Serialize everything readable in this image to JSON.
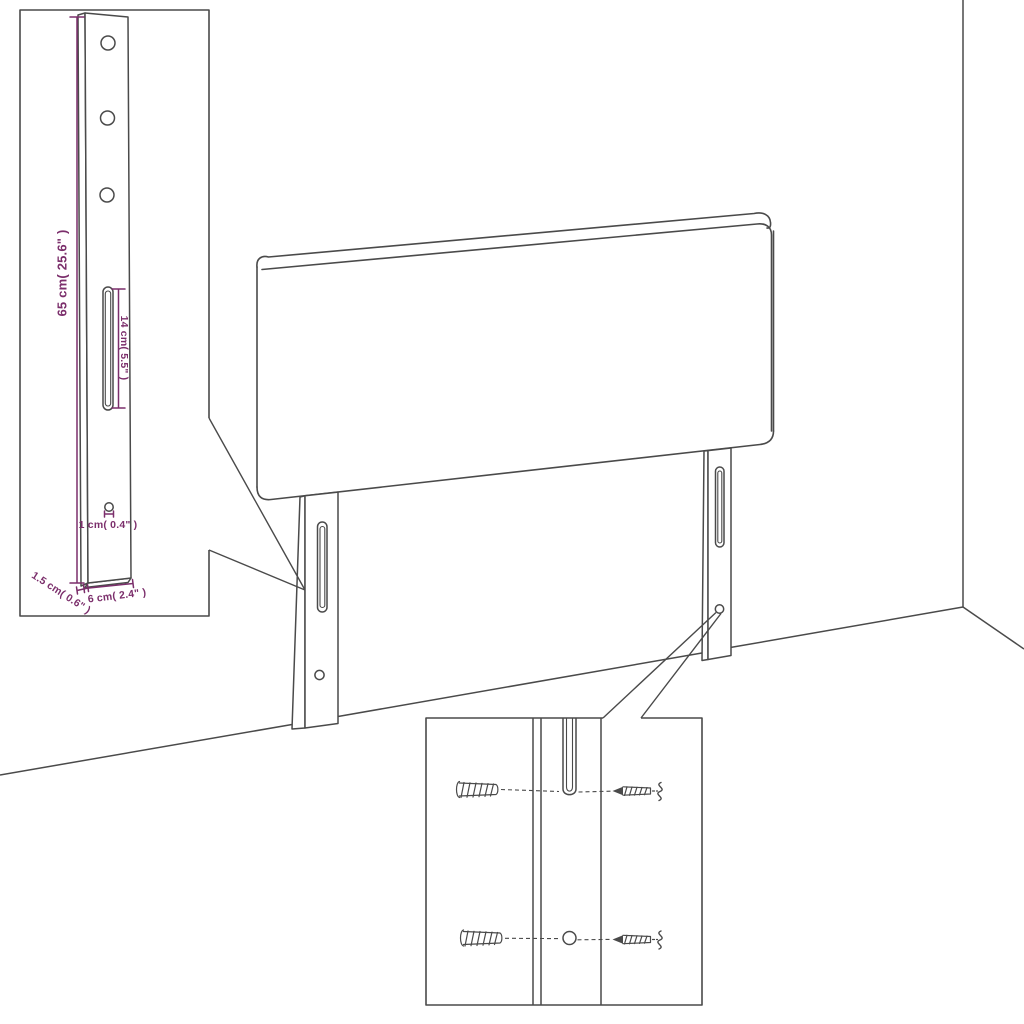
{
  "diagram": {
    "type": "headboard-assembly-dimension-diagram",
    "background": "#ffffff",
    "line_color": "#4a4a4a",
    "dimension_color": "#7b2e6b",
    "detail_inset": {
      "dim_height": "65 cm( 25.6\" )",
      "dim_slot": "14 cm( 5.5\" )",
      "dim_hole": "1 cm( 0.4\" )",
      "dim_thickness": "1.5 cm( 0.6\" )",
      "dim_width": "6 cm( 2.4\" )"
    },
    "hardware_inset": {
      "icons": [
        "wall-plug-icon",
        "screw-icon"
      ]
    }
  }
}
